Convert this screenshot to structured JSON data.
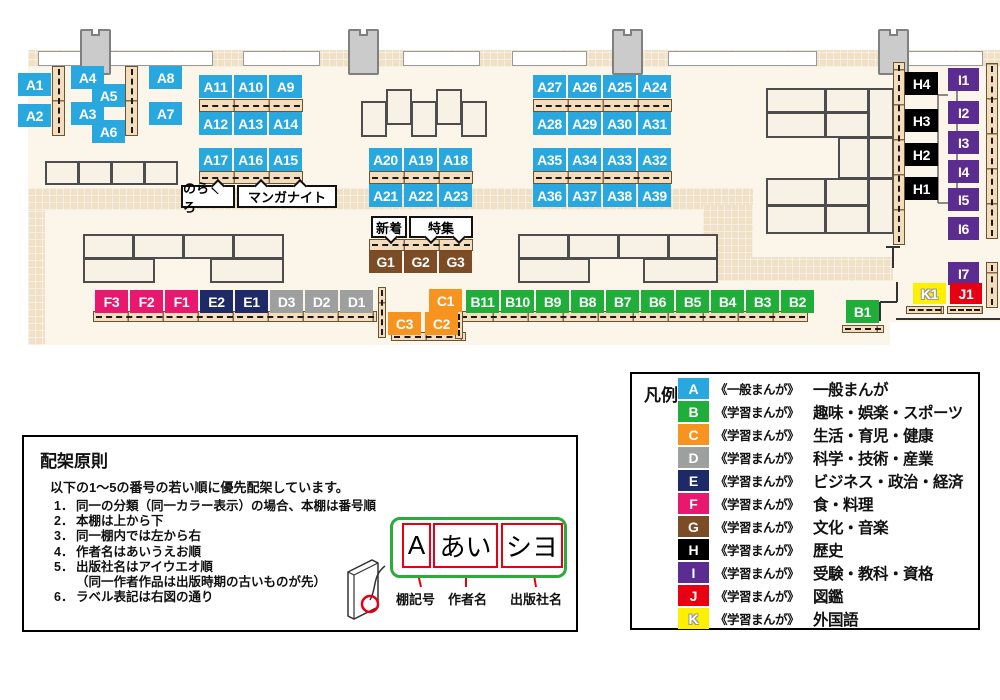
{
  "colors": {
    "A": "#29a8e0",
    "B": "#1fae3a",
    "C": "#f79420",
    "D": "#9e9f9f",
    "E": "#1e2a68",
    "F": "#e9186f",
    "G": "#7b4c26",
    "H": "#000000",
    "I": "#5c2d91",
    "J": "#e60012",
    "K": "#fff000"
  },
  "map": {
    "annotations": {
      "norakuro": "のらくろ",
      "manga_night": "マンガナイト",
      "new_arrivals": "新着",
      "feature": "特集"
    },
    "shelf_labels": [
      {
        "id": "A1",
        "cat": "A",
        "x": 18,
        "y": 73
      },
      {
        "id": "A2",
        "cat": "A",
        "x": 18,
        "y": 104
      },
      {
        "id": "A4",
        "cat": "A",
        "x": 71,
        "y": 66
      },
      {
        "id": "A5",
        "cat": "A",
        "x": 92,
        "y": 84
      },
      {
        "id": "A3",
        "cat": "A",
        "x": 71,
        "y": 102
      },
      {
        "id": "A6",
        "cat": "A",
        "x": 92,
        "y": 120
      },
      {
        "id": "A8",
        "cat": "A",
        "x": 149,
        "y": 66
      },
      {
        "id": "A7",
        "cat": "A",
        "x": 149,
        "y": 102
      },
      {
        "id": "A11",
        "cat": "A",
        "x": 199,
        "y": 75
      },
      {
        "id": "A10",
        "cat": "A",
        "x": 234,
        "y": 75
      },
      {
        "id": "A9",
        "cat": "A",
        "x": 269,
        "y": 75
      },
      {
        "id": "A12",
        "cat": "A",
        "x": 199,
        "y": 112
      },
      {
        "id": "A13",
        "cat": "A",
        "x": 234,
        "y": 112
      },
      {
        "id": "A14",
        "cat": "A",
        "x": 269,
        "y": 112
      },
      {
        "id": "A17",
        "cat": "A",
        "x": 199,
        "y": 148
      },
      {
        "id": "A16",
        "cat": "A",
        "x": 234,
        "y": 148
      },
      {
        "id": "A15",
        "cat": "A",
        "x": 269,
        "y": 148
      },
      {
        "id": "A20",
        "cat": "A",
        "x": 369,
        "y": 148
      },
      {
        "id": "A19",
        "cat": "A",
        "x": 404,
        "y": 148
      },
      {
        "id": "A18",
        "cat": "A",
        "x": 439,
        "y": 148
      },
      {
        "id": "A21",
        "cat": "A",
        "x": 369,
        "y": 184
      },
      {
        "id": "A22",
        "cat": "A",
        "x": 404,
        "y": 184
      },
      {
        "id": "A23",
        "cat": "A",
        "x": 439,
        "y": 184
      },
      {
        "id": "A27",
        "cat": "A",
        "x": 533,
        "y": 75
      },
      {
        "id": "A26",
        "cat": "A",
        "x": 568,
        "y": 75
      },
      {
        "id": "A25",
        "cat": "A",
        "x": 603,
        "y": 75
      },
      {
        "id": "A24",
        "cat": "A",
        "x": 638,
        "y": 75
      },
      {
        "id": "A28",
        "cat": "A",
        "x": 533,
        "y": 112
      },
      {
        "id": "A29",
        "cat": "A",
        "x": 568,
        "y": 112
      },
      {
        "id": "A30",
        "cat": "A",
        "x": 603,
        "y": 112
      },
      {
        "id": "A31",
        "cat": "A",
        "x": 638,
        "y": 112
      },
      {
        "id": "A35",
        "cat": "A",
        "x": 533,
        "y": 148
      },
      {
        "id": "A34",
        "cat": "A",
        "x": 568,
        "y": 148
      },
      {
        "id": "A33",
        "cat": "A",
        "x": 603,
        "y": 148
      },
      {
        "id": "A32",
        "cat": "A",
        "x": 638,
        "y": 148
      },
      {
        "id": "A36",
        "cat": "A",
        "x": 533,
        "y": 184
      },
      {
        "id": "A37",
        "cat": "A",
        "x": 568,
        "y": 184
      },
      {
        "id": "A38",
        "cat": "A",
        "x": 603,
        "y": 184
      },
      {
        "id": "A39",
        "cat": "A",
        "x": 638,
        "y": 184
      },
      {
        "id": "G1",
        "cat": "G",
        "x": 369,
        "y": 250
      },
      {
        "id": "G2",
        "cat": "G",
        "x": 404,
        "y": 250
      },
      {
        "id": "G3",
        "cat": "G",
        "x": 439,
        "y": 250
      },
      {
        "id": "F3",
        "cat": "F",
        "x": 95,
        "y": 290
      },
      {
        "id": "F2",
        "cat": "F",
        "x": 130,
        "y": 290
      },
      {
        "id": "F1",
        "cat": "F",
        "x": 165,
        "y": 290
      },
      {
        "id": "E2",
        "cat": "E",
        "x": 200,
        "y": 290
      },
      {
        "id": "E1",
        "cat": "E",
        "x": 235,
        "y": 290
      },
      {
        "id": "D3",
        "cat": "D",
        "x": 270,
        "y": 290
      },
      {
        "id": "D2",
        "cat": "D",
        "x": 305,
        "y": 290
      },
      {
        "id": "D1",
        "cat": "D",
        "x": 340,
        "y": 290
      },
      {
        "id": "C1",
        "cat": "C",
        "x": 429,
        "y": 289
      },
      {
        "id": "C3",
        "cat": "C",
        "x": 388,
        "y": 312
      },
      {
        "id": "C2",
        "cat": "C",
        "x": 425,
        "y": 312
      },
      {
        "id": "B11",
        "cat": "B",
        "x": 466,
        "y": 290
      },
      {
        "id": "B10",
        "cat": "B",
        "x": 501,
        "y": 290
      },
      {
        "id": "B9",
        "cat": "B",
        "x": 536,
        "y": 290
      },
      {
        "id": "B8",
        "cat": "B",
        "x": 571,
        "y": 290
      },
      {
        "id": "B7",
        "cat": "B",
        "x": 606,
        "y": 290
      },
      {
        "id": "B6",
        "cat": "B",
        "x": 641,
        "y": 290
      },
      {
        "id": "B5",
        "cat": "B",
        "x": 676,
        "y": 290
      },
      {
        "id": "B4",
        "cat": "B",
        "x": 711,
        "y": 290
      },
      {
        "id": "B3",
        "cat": "B",
        "x": 746,
        "y": 290
      },
      {
        "id": "B2",
        "cat": "B",
        "x": 781,
        "y": 290
      },
      {
        "id": "B1",
        "cat": "B",
        "x": 846,
        "y": 300
      },
      {
        "id": "H4",
        "cat": "H",
        "x": 905,
        "y": 72
      },
      {
        "id": "H3",
        "cat": "H",
        "x": 905,
        "y": 109
      },
      {
        "id": "H2",
        "cat": "H",
        "x": 905,
        "y": 143
      },
      {
        "id": "H1",
        "cat": "H",
        "x": 905,
        "y": 177
      },
      {
        "id": "I1",
        "cat": "I",
        "x": 948,
        "y": 68,
        "w": 31
      },
      {
        "id": "I2",
        "cat": "I",
        "x": 948,
        "y": 101,
        "w": 31
      },
      {
        "id": "I3",
        "cat": "I",
        "x": 948,
        "y": 131,
        "w": 31
      },
      {
        "id": "I4",
        "cat": "I",
        "x": 948,
        "y": 160,
        "w": 31
      },
      {
        "id": "I5",
        "cat": "I",
        "x": 948,
        "y": 188,
        "w": 31
      },
      {
        "id": "I6",
        "cat": "I",
        "x": 948,
        "y": 217,
        "w": 31
      },
      {
        "id": "I7",
        "cat": "I",
        "x": 948,
        "y": 262,
        "w": 31
      },
      {
        "id": "K1",
        "cat": "K",
        "x": 913,
        "y": 283,
        "h": 21
      },
      {
        "id": "J1",
        "cat": "J",
        "x": 950,
        "y": 283,
        "w": 32,
        "h": 21
      }
    ]
  },
  "legend": {
    "title": "凡例",
    "items": [
      {
        "letter": "A",
        "series": "《一般まんが》",
        "category": "一般まんが"
      },
      {
        "letter": "B",
        "series": "《学習まんが》",
        "category": "趣味・娯楽・スポーツ"
      },
      {
        "letter": "C",
        "series": "《学習まんが》",
        "category": "生活・育児・健康"
      },
      {
        "letter": "D",
        "series": "《学習まんが》",
        "category": "科学・技術・産業"
      },
      {
        "letter": "E",
        "series": "《学習まんが》",
        "category": "ビジネス・政治・経済"
      },
      {
        "letter": "F",
        "series": "《学習まんが》",
        "category": "食・料理"
      },
      {
        "letter": "G",
        "series": "《学習まんが》",
        "category": "文化・音楽"
      },
      {
        "letter": "H",
        "series": "《学習まんが》",
        "category": "歴史"
      },
      {
        "letter": "I",
        "series": "《学習まんが》",
        "category": "受験・教科・資格"
      },
      {
        "letter": "J",
        "series": "《学習まんが》",
        "category": "図鑑"
      },
      {
        "letter": "K",
        "series": "《学習まんが》",
        "category": "外国語"
      }
    ]
  },
  "rules": {
    "title": "配架原則",
    "intro": "以下の1～5の番号の若い順に優先配架しています。",
    "items": [
      {
        "num": "1．",
        "text": "同一の分類（同一カラー表示）の場合、本棚は番号順"
      },
      {
        "num": "2．",
        "text": "本棚は上から下"
      },
      {
        "num": "3．",
        "text": "同一棚内では左から右"
      },
      {
        "num": "4．",
        "text": "作者名はあいうえお順"
      },
      {
        "num": "5．",
        "text": "出版社名はアイウエオ順",
        "sub": "（同一作者作品は出版時期の古いものが先）"
      },
      {
        "num": "6．",
        "text": "ラベル表記は右図の通り"
      }
    ],
    "label_diagram": {
      "shelf_code": "A",
      "author": "あい",
      "publisher": "シヨ",
      "captions": {
        "shelf_code": "棚記号",
        "author": "作者名",
        "publisher": "出版社名"
      }
    }
  }
}
